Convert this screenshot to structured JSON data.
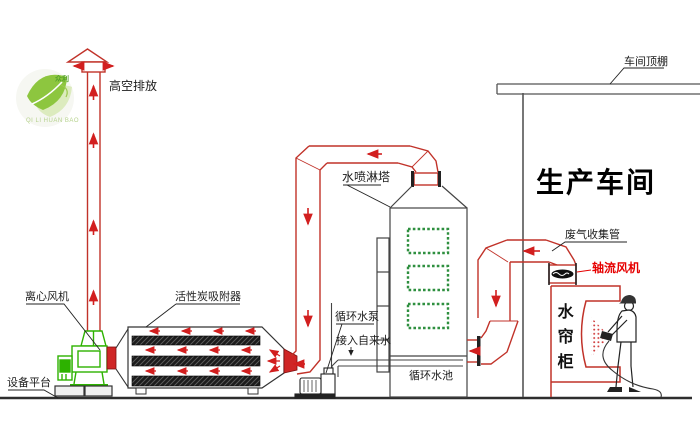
{
  "diagram_type": "exhaust-gas-treatment-process-flow",
  "colors": {
    "duct_red": "#c13229",
    "flow_arrow_red": "#d21f1f",
    "fan_green": "#2db200",
    "window_green": "#2e8f3f",
    "axial_fan_label_red": "#e60000",
    "logo_leaf_green": "#8dc63f",
    "line_dark": "#444444"
  },
  "labels": {
    "high_emission": "高空排放",
    "workshop_ceiling": "车间顶棚",
    "production_workshop": "生产车间",
    "spray_tower": "水喷淋塔",
    "exhaust_collection_pipe": "废气收集管",
    "axial_fan": "轴流风机",
    "water_curtain_cabinet": "水帘柜",
    "centrifugal_fan": "离心风机",
    "activated_carbon_adsorber": "活性炭吸附器",
    "equipment_platform": "设备平台",
    "circulating_water_pump": "循环水泵",
    "tap_water_inlet": "接入自来水",
    "circulating_water_pool": "循环水池"
  },
  "logo": {
    "inner_label": "众利",
    "caption": "QI LI HUAN BAO"
  }
}
